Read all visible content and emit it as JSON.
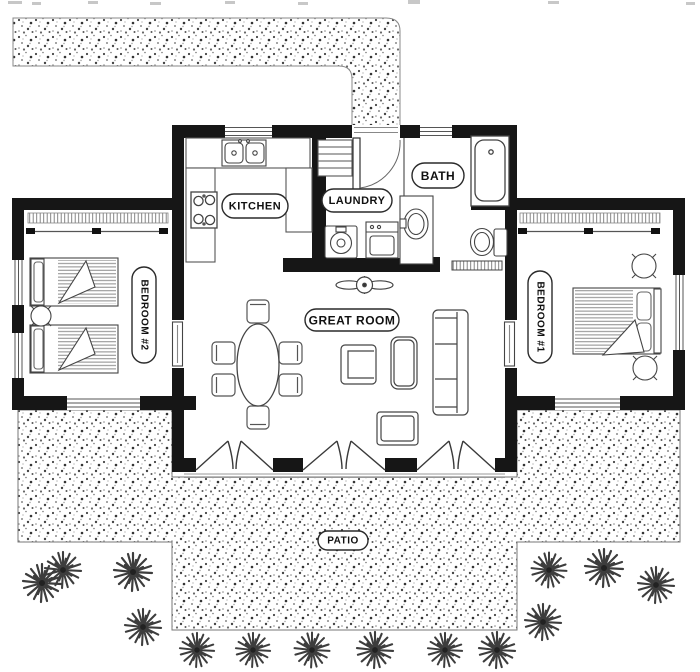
{
  "document": {
    "type": "floor-plan",
    "style": "black-and-white architectural drawing"
  },
  "colors": {
    "background": "#ffffff",
    "walls": "#161616",
    "thin_lines": "#555555",
    "stipple_dots": "#4a4a4a",
    "label_border": "#2a2a2a",
    "label_text": "#111111"
  },
  "rooms": {
    "kitchen": "KITCHEN",
    "laundry": "LAUNDRY",
    "bath": "BATH",
    "great_room": "GREAT ROOM",
    "bedroom_1": "BEDROOM #1",
    "bedroom_2": "BEDROOM #2",
    "patio": "PATIO"
  },
  "symbols": [
    "driveway-walkway",
    "front-door",
    "kitchen-sink",
    "stove",
    "kitchen-counter",
    "laundry-shelf",
    "washer",
    "dryer",
    "bathtub",
    "vanity-sink",
    "toilet",
    "bath-door",
    "ceiling-fan",
    "dining-table",
    "dining-chair",
    "armchair",
    "coffee-table",
    "sofa",
    "ottoman",
    "french-doors",
    "closet",
    "twin-bed",
    "double-bed",
    "nightstand",
    "bedside-table",
    "window",
    "interior-door",
    "patio",
    "shrub"
  ]
}
